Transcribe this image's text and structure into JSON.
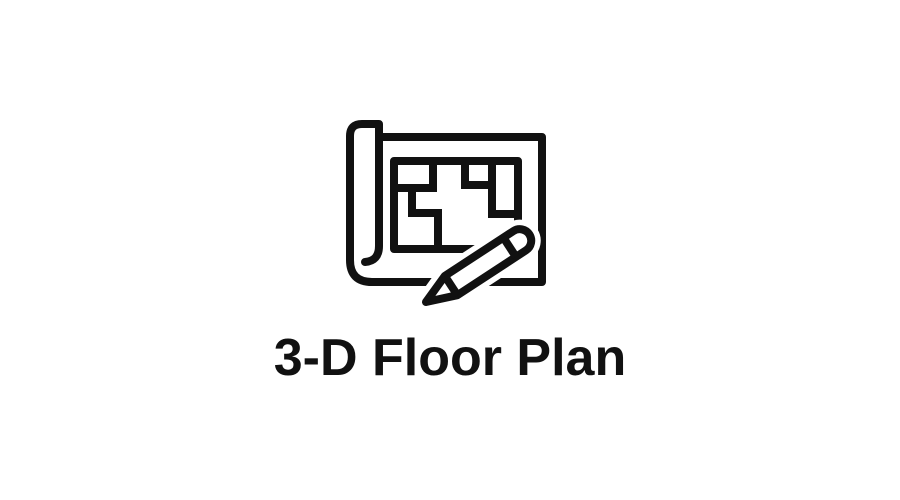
{
  "page": {
    "background_color": "#ffffff"
  },
  "feature": {
    "label": "3-D Floor Plan",
    "icon": "floor-plan-blueprint-pencil-icon",
    "icon_color": "#111111",
    "text_color": "#111111"
  }
}
